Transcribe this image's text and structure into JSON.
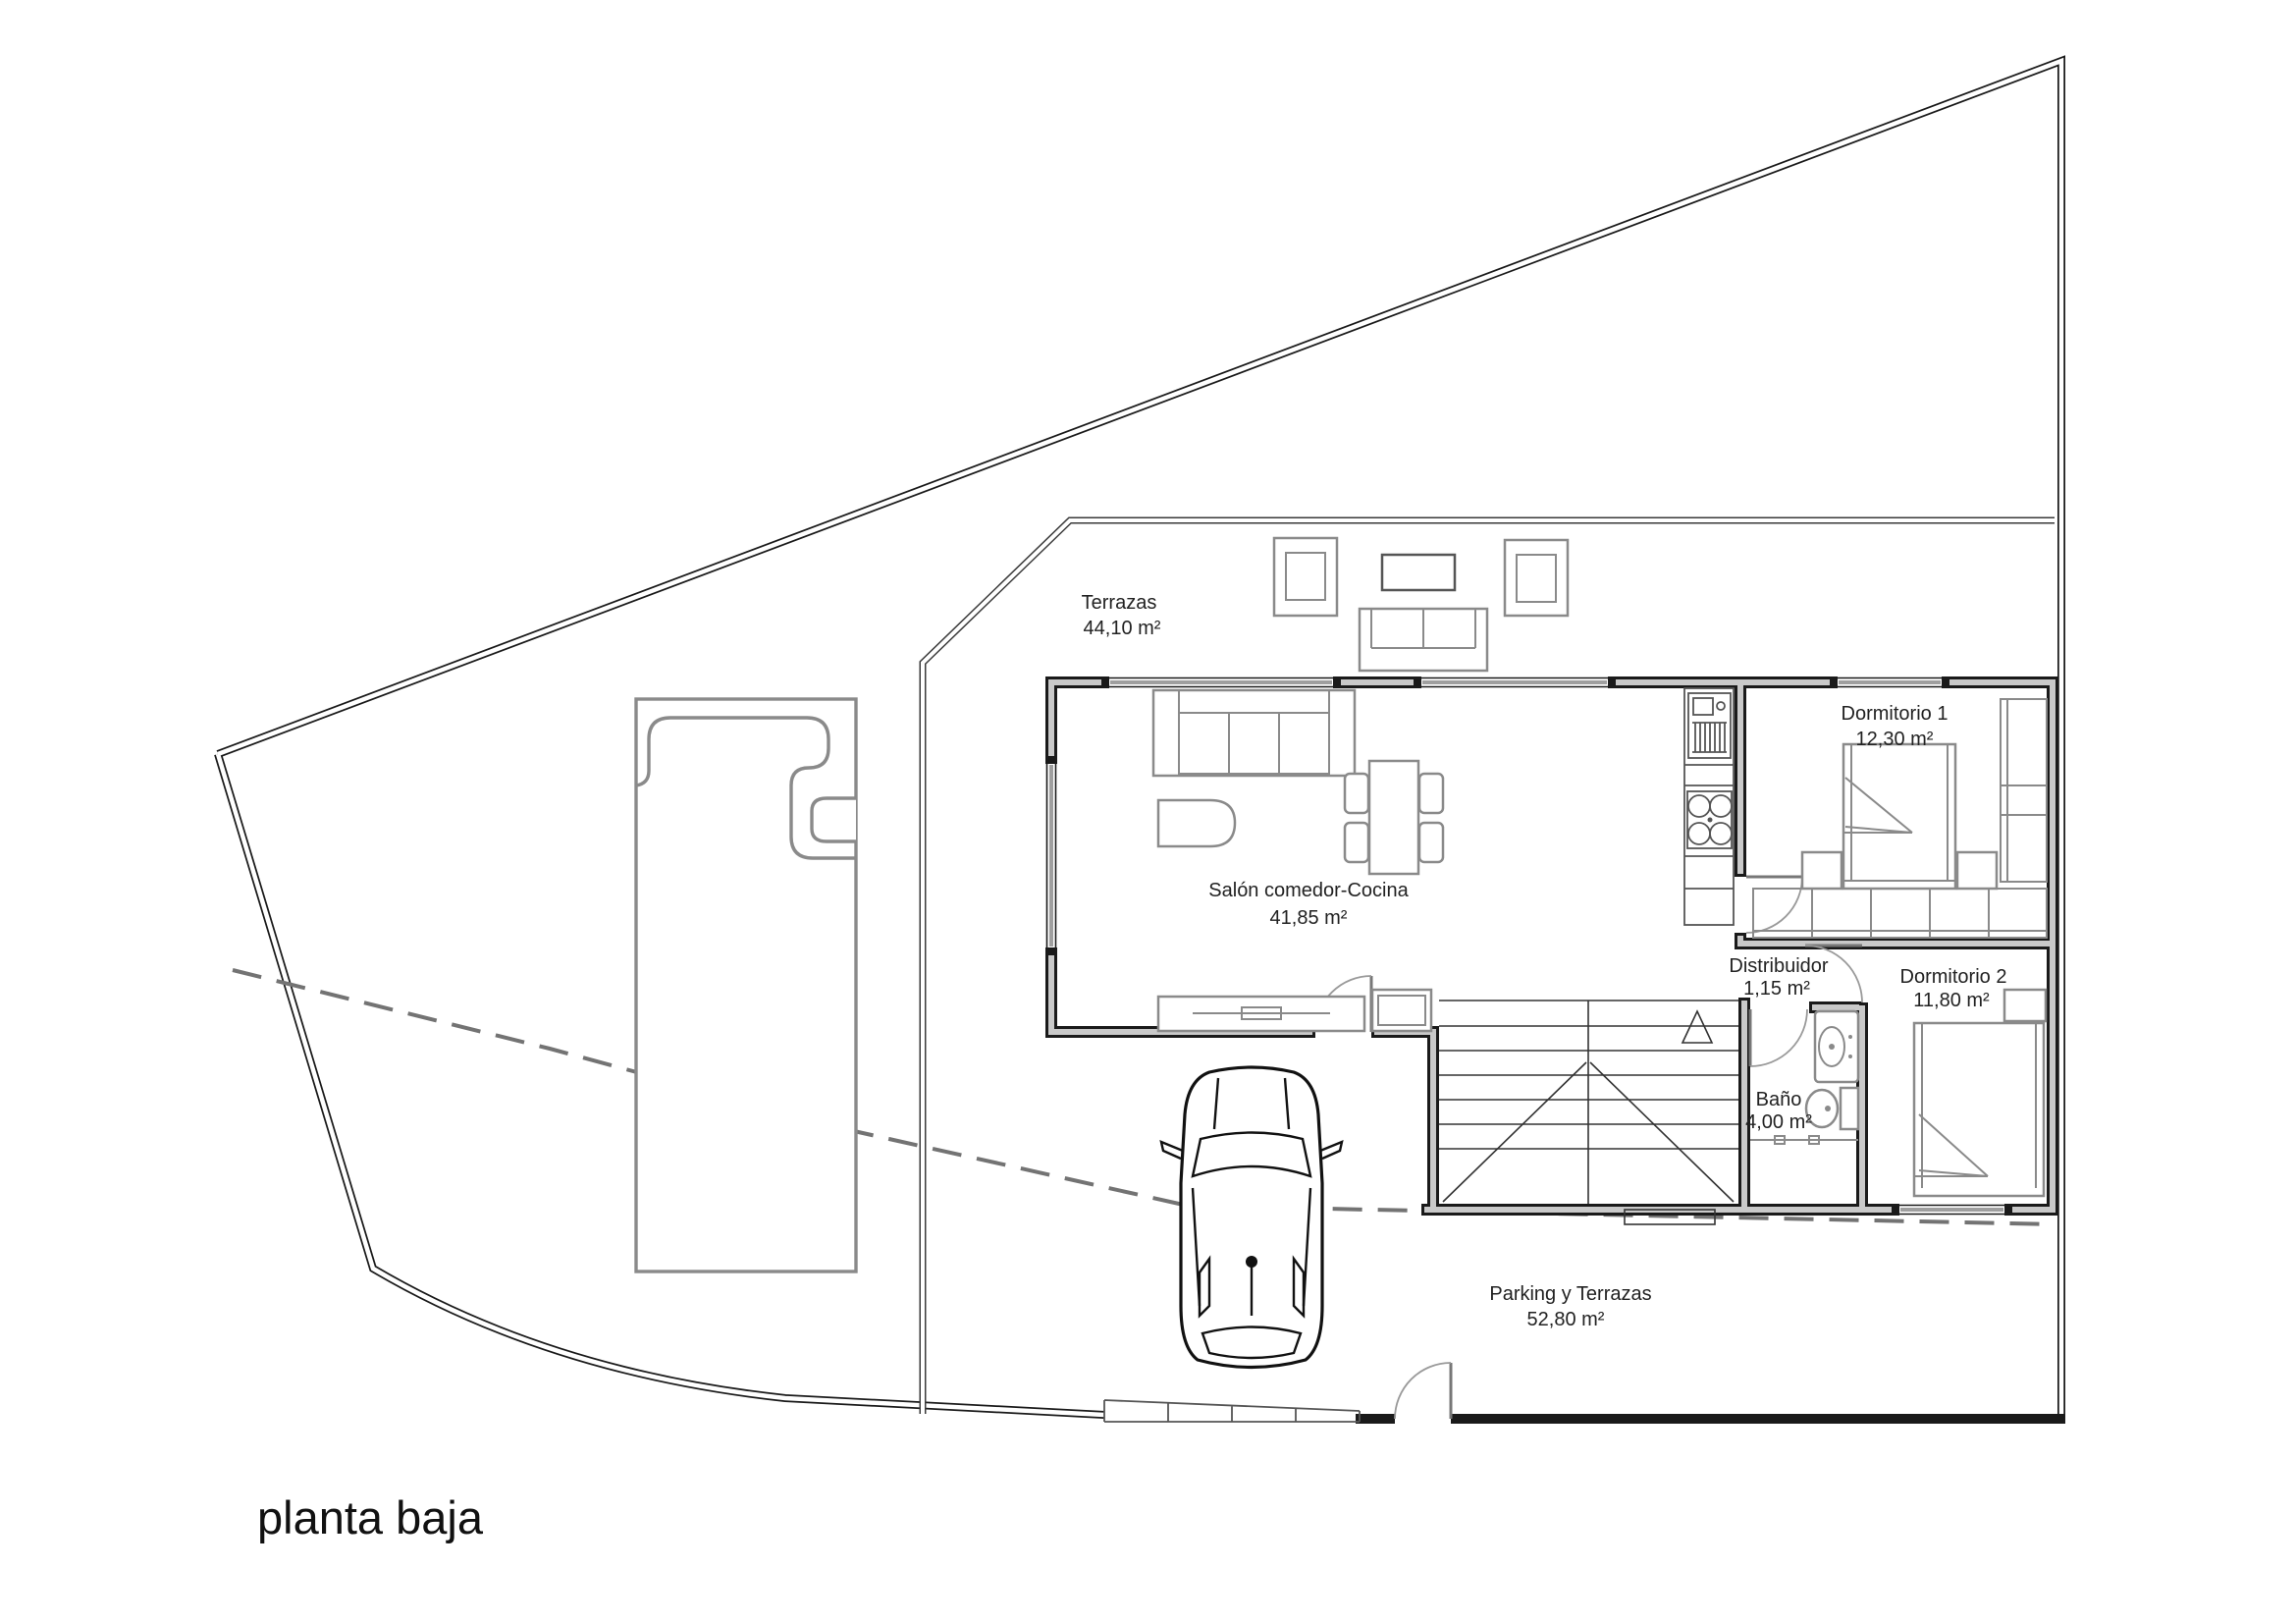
{
  "title": "planta baja",
  "drawing_type": "floor-plan",
  "rooms": [
    {
      "name": "Terrazas",
      "area": "44,10 m²"
    },
    {
      "name": "Salón comedor-Cocina",
      "area": "41,85 m²"
    },
    {
      "name": "Dormitorio 1",
      "area": "12,30 m²"
    },
    {
      "name": "Distribuidor",
      "area": "1,15 m²"
    },
    {
      "name": "Dormitorio 2",
      "area": "11,80 m²"
    },
    {
      "name": "Baño",
      "area": "4,00 m²"
    },
    {
      "name": "Parking y Terrazas",
      "area": "52,80 m²"
    }
  ],
  "colors": {
    "wall": "#1a1a1a",
    "wall_fill": "#c9c9c9",
    "furniture": "#8a8a8a",
    "dashed_line": "#737373",
    "text": "#222222",
    "background": "#ffffff"
  }
}
